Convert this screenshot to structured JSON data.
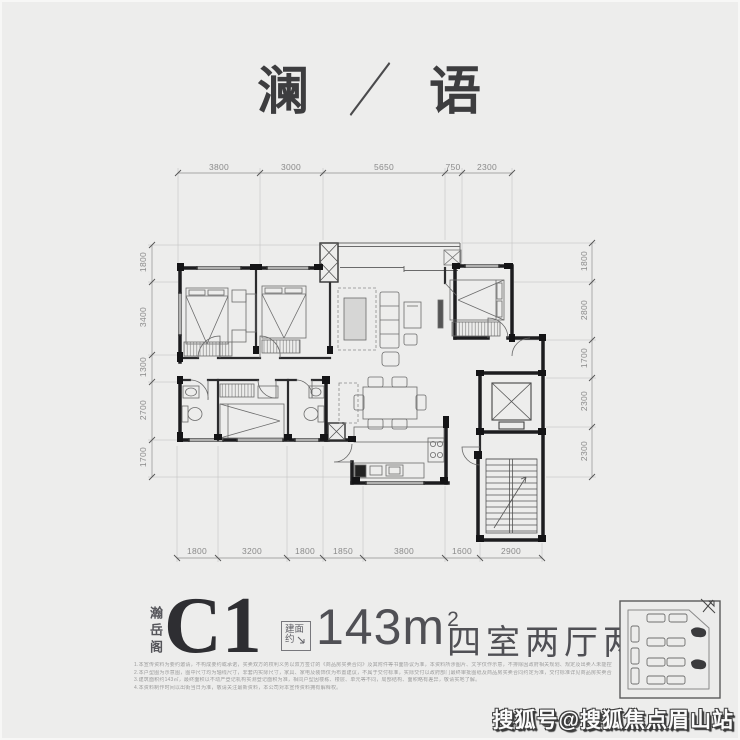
{
  "page": {
    "title": {
      "left": "澜",
      "separator": "／",
      "right": "语"
    }
  },
  "plan": {
    "dims_top": [
      "3800",
      "3000",
      "5650",
      "750",
      "2300"
    ],
    "dims_bottom": [
      "1800",
      "3200",
      "1800",
      "1850",
      "3800",
      "1600",
      "2900"
    ],
    "dims_left": [
      "1800",
      "3400",
      "1300",
      "2700",
      "1700"
    ],
    "dims_right": [
      "1800",
      "2800",
      "1700",
      "2300",
      "2300"
    ]
  },
  "info": {
    "building": "瀚岳阁",
    "unit": "C1",
    "area_label_top": "建面",
    "area_label_bottom": "约",
    "area_value": "143m",
    "area_sup": "2",
    "layout": "四室两厅两卫",
    "disclaimer_lines": [
      "1.本宣传资料为要约邀请，不构成要约或承诺，买卖双方的权利义务以双方签订的《商品房买卖合同》及其附件等书面协议为准，本资料所涉图片、文字仅作示意，不排除因政府相关规划、规定及出卖人未能控制的原因而发生变化，本公司保留修改权利。",
      "2.本户型图为示意图，图中尺寸均为轴线尺寸，非套内实际尺寸，家具、家电及装饰仅为布置建议，不属于交付标准，实际交付以政府部门最终审批图纸及商品房买卖合同约定为准，交付标准详见商品房买卖合同约定。",
      "3.建筑面积约143㎡，最终面积以不动产登记机构实测登记面积为准，相同户型因楼栋、楼层、单元等不同，局部结构、面积略有差异，敬请实地了解。",
      "4.本资料制作时间以出街当日为准，敬请关注最新资料，本公司对本宣传资料拥有解释权。"
    ]
  },
  "inset": {
    "label": "site-plan"
  },
  "watermark": {
    "text": "搜狐号@搜狐焦点眉山站"
  }
}
